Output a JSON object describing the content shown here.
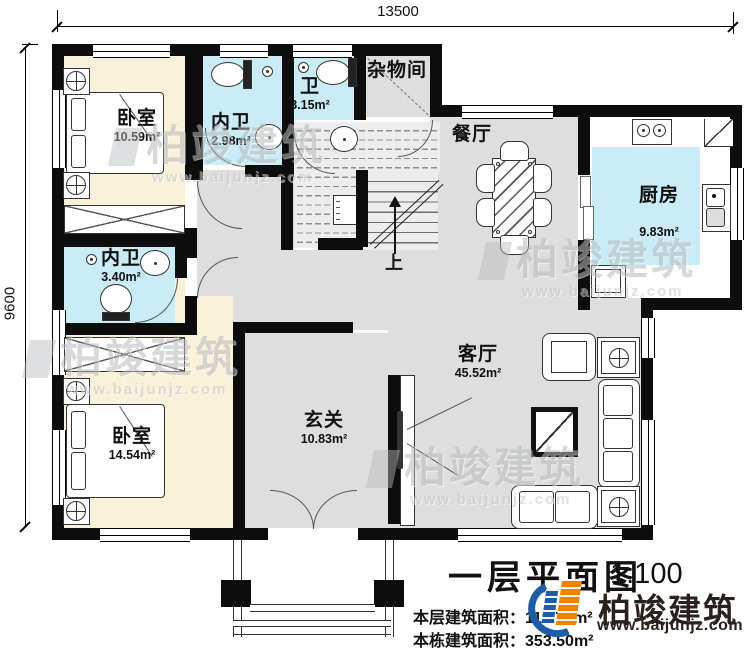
{
  "dimensions": {
    "width_mm": "13500",
    "height_mm": "9600"
  },
  "rooms": {
    "bedroom_top": {
      "name": "卧室",
      "area": "10.59m²"
    },
    "ensuite_top": {
      "name": "内卫",
      "area": "2.98m²"
    },
    "bath": {
      "name": "卫",
      "area": "3.15m²"
    },
    "storage": {
      "name": "杂物间",
      "area": ""
    },
    "dining": {
      "name": "餐厅",
      "area": ""
    },
    "kitchen": {
      "name": "厨房",
      "area": "9.83m²"
    },
    "ensuite_left": {
      "name": "内卫",
      "area": "3.40m²"
    },
    "bedroom_bottom": {
      "name": "卧室",
      "area": "14.54m²"
    },
    "entry": {
      "name": "玄关",
      "area": "10.83m²"
    },
    "living": {
      "name": "客厅",
      "area": "45.52m²"
    }
  },
  "stairs": {
    "up": "上"
  },
  "title_block": {
    "title": "一层平面图",
    "scale": "1:100",
    "floor_area_label": "本层建筑面积：",
    "floor_area_value": "119.70m²",
    "total_area_label": "本栋建筑面积：",
    "total_area_value": "353.50m²"
  },
  "brand": {
    "name": "柏竣建筑",
    "url": "www.baijunjz.com"
  },
  "watermark": {
    "name": "柏竣建筑",
    "url": "www.baijunjz.com"
  },
  "colors": {
    "bedroom_fill": "#faf1da",
    "bath_fill": "#c9ecf6",
    "hall_fill": "#dedede",
    "wall": "#0d0d0d",
    "brand_orange": "#f08200",
    "brand_blue": "#1d5da8",
    "brand_dark": "#2a211c"
  }
}
